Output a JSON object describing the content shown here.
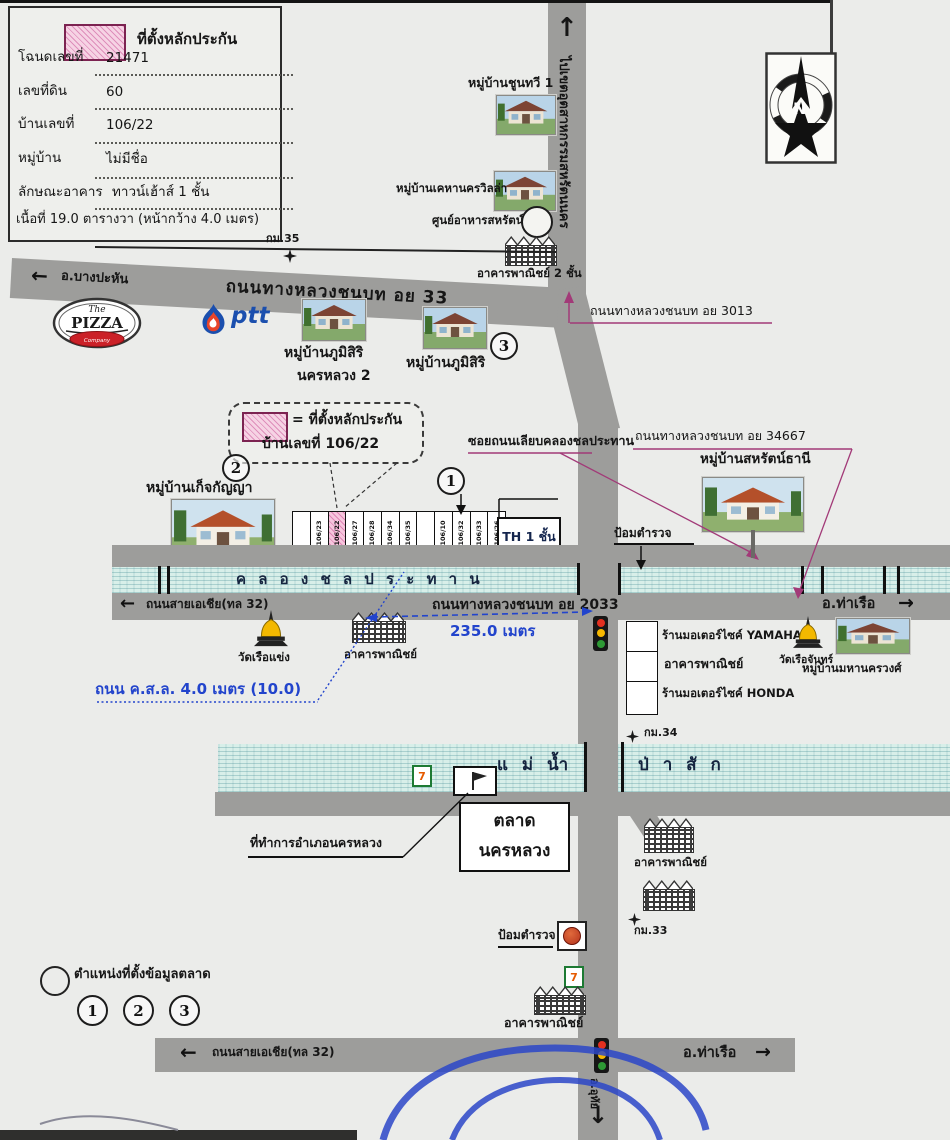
{
  "legend": {
    "swatch_label": "ที่ตั้งหลักประกัน",
    "rows": [
      {
        "label": "โฉนดเลขที่",
        "value": "21471"
      },
      {
        "label": "เลขที่ดิน",
        "value": "60"
      },
      {
        "label": "บ้านเลขที่",
        "value": "106/22"
      },
      {
        "label": "หมู่บ้าน",
        "value": "ไม่มีชื่อ"
      },
      {
        "label": "ลักษณะอาคาร",
        "value": "ทาวน์เฮ้าส์ 1 ชั้น"
      }
    ],
    "area_line": "เนื้อที่ 19.0 ตารางวา (หน้ากว้าง 4.0 เมตร)"
  },
  "compass": {
    "north": "N"
  },
  "icons": {
    "arrow_left": "←",
    "arrow_right": "→",
    "arrow_up": "↑",
    "arrow_down": "↓"
  },
  "roads": {
    "industrial_dir": "ไปเขตอุตสาหกรรมสหรัตนนคร",
    "hwy33": "ถนนทางหลวงชนบท อย 33",
    "bang_pahan": "อ.บางปะหัน",
    "hwy3013": "ถนนทางหลวงชนบท อย 3013",
    "hwy34667": "ถนนทางหลวงชนบท อย 34667",
    "soi_canal": "ซอยถนนเลียบคลองชลประทาน",
    "hwy2033": "ถนนทางหลวงชนบท อย 2033",
    "asia_mid": "ถนนสายเอเชีย(ทล 32)",
    "tha_ruea_mid": "อ.ท่าเรือ",
    "concrete": "ถนน ค.ส.ล. 4.0 เมตร (10.0)",
    "asia_bottom": "ถนนสายเอเชีย(ทล 32)",
    "tha_ruea_bottom": "อ.ท่าเรือ",
    "south_dir": "อ.อุทัย"
  },
  "km": {
    "k35": "กม.35",
    "k34": "กม.34",
    "k33": "กม.33"
  },
  "canal": {
    "name": "ค ล อ ง ช ล ป ร ะ ท า น"
  },
  "river": {
    "part1": "แ ม่ น้ำ",
    "part2": "ป่ า สั ก"
  },
  "callout": {
    "line1": "= ที่ตั้งหลักประกัน",
    "line2": "บ้านเลขที่ 106/22"
  },
  "villages": {
    "chunthawi": "หมู่บ้านชูนทวี 1",
    "khehanakhon": "หมู่บ้านเคหานครวิลล่า",
    "phumisiri2_l1": "หมู่บ้านภูมิสิริ",
    "phumisiri2_l2": "นครหลวง 2",
    "phumisiri": "หมู่บ้านภูมิสิริ",
    "ketkanya": "หมู่บ้านเก็จกัญญา",
    "saharat_thani": "หมู่บ้านสหรัตน์ธานี",
    "mahanakhon": "หมู่บ้านมหานครวงศ์"
  },
  "places": {
    "food_center": "ศูนย์อาหารสหรัตน์",
    "commercial2fl": "อาคารพาณิชย์ 2 ชั้น",
    "commercial": "อาคารพาณิชย์",
    "wat_ruea_khaeng": "วัดเรือแข่ง",
    "wat_ruea_chan": "วัดเรือจันทร์",
    "police_box": "ป้อมตำรวจ",
    "th_house": "TH 1 ชั้น",
    "yamaha": "ร้านมอเตอร์ไซค์ YAMAHA",
    "honda": "ร้านมอเตอร์ไซค์ HONDA",
    "market_l1": "ตลาด",
    "market_l2": "นครหลวง",
    "district_office": "ที่ทำการอำเภอนครหลวง",
    "seven": "7"
  },
  "brands": {
    "pizza_the": "The",
    "pizza": "PIZZA",
    "pizza_sub": "Company",
    "ptt": "ptt"
  },
  "measure": {
    "m235": "235.0 เมตร"
  },
  "plots": {
    "cells": [
      "",
      "106/23",
      "106/22",
      "106/27",
      "106/28",
      "106/34",
      "106/35",
      "",
      "106/10",
      "106/32",
      "106/33",
      "106/26"
    ],
    "highlight_index": 2
  },
  "numbers": {
    "n1": "1",
    "n2": "2",
    "n3": "3"
  },
  "bottom_legend": {
    "label": "ตำแหน่งที่ตั้งข้อมูลตลาด"
  },
  "colors": {
    "road": "#9d9d9b",
    "canal": "#d8efe9",
    "pink": "#f2c3da",
    "magenta": "#a23a78",
    "blue": "#2244cc"
  }
}
